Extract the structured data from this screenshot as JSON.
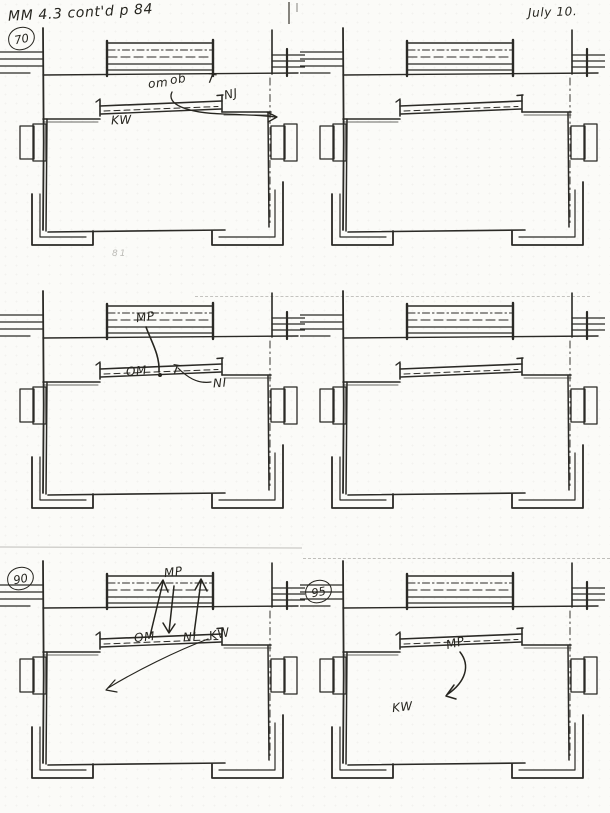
{
  "page": {
    "description": "Scanned hand-drawn stage blocking score, six floor-plan panels",
    "ink_color": "#2b2a26",
    "paper_color": "#fbfbf8"
  },
  "header": {
    "left_note": "MM 4.3 cont'd p 84",
    "right_note": "July 10."
  },
  "pencil_mark": "81",
  "panels": [
    {
      "cue": "70",
      "labels": {
        "om": "om",
        "ob": "ob",
        "t": "T",
        "nj": "NJ",
        "kw": "KW"
      }
    },
    {
      "labels": {}
    },
    {
      "labels": {
        "mp": "MP",
        "om": "OM",
        "t": "T",
        "ni": "NI"
      }
    },
    {
      "labels": {}
    },
    {
      "cue": "90",
      "labels": {
        "mp": "MP",
        "om": "OM",
        "ni": "NI",
        "kw": "KW"
      }
    },
    {
      "cue": "95",
      "labels": {
        "mp": "MP",
        "kw": "KW"
      }
    }
  ]
}
